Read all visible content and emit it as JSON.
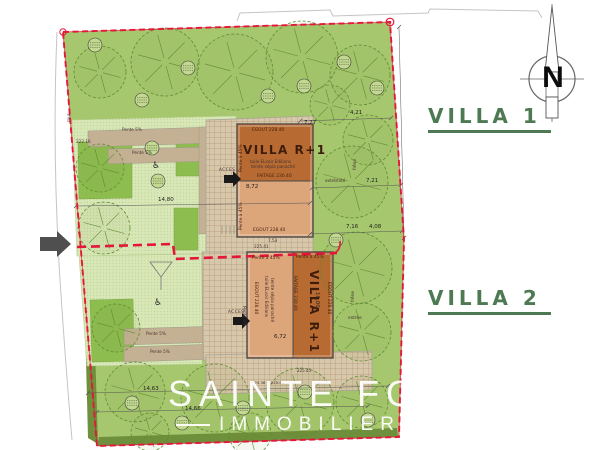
{
  "labels": {
    "villa1": "VILLA 1",
    "villa2": "VILLA 2"
  },
  "compass": {
    "north": "N"
  },
  "logo": {
    "name": "SAINTE FOY",
    "tagline": "IMMOBILIER"
  },
  "v1": {
    "name": "VILLA R+1",
    "egout_top": "EGOUT 228.40",
    "tile_line1": "tuile ELvoir Edilians",
    "tile_line2": "teinte sépia panaché",
    "faitage": "FAITAGE 230.40",
    "width": "8,72",
    "slope_left_top": "Pente à 45%",
    "slope_left_bottom": "Pente à 45%",
    "egout_bottom": "EGOUT 228.40"
  },
  "v2": {
    "name": "VILLA R+1",
    "slope_a": "Pente à 45%",
    "slope_b": "Pente à 45%",
    "faitage": "FAITAGE 230.40",
    "tile_line1": "tuile ELvoir Edilians",
    "tile_line2": "teinte sépia panaché",
    "egout_left": "EGOUT 228.40",
    "egout_right": "EGOUT 228.40",
    "width": "6,72",
    "depth": "10,00"
  },
  "site": {
    "slope1": "Pente 5%",
    "slope2": "Pente 5%",
    "slope3": "Pente 5%",
    "slope4": "Pente 5%",
    "slope5": "Pente 5%",
    "level_222_16": "222.16",
    "dim_14_80": "14,80",
    "acces1": "ACCES",
    "acces2": "ACCES",
    "dim_7_53": "7,53",
    "level_225_41": "225.41",
    "dim_4_21": "4,21",
    "dim_7_27": "7,27",
    "dim_7_16": "7,16",
    "dim_4_08": "4,08",
    "dim_7_21": "7,21",
    "extremite": "extrémité",
    "frene1": "frêne",
    "frene2": "frêne",
    "entree": "entrée",
    "mur": "mur",
    "dim_14_63": "14,63",
    "dim_14_66": "14,66",
    "terrace_levels": "225.36 + 225.80",
    "level_225_45": "225.45"
  },
  "icons": {
    "wheelchair": "♿"
  },
  "colors": {
    "boundary_red": "#e31739",
    "grass": "#a6c76d",
    "lawn": "#d8e7b6",
    "patch": "#8ebd4f",
    "driveway": "#c4b193",
    "court": "#d7c7ab",
    "roof_dark": "#b76a31",
    "roof_light": "#dca57a",
    "dark_hedge": "#6e8f3b",
    "label_green": "#4d7a52"
  }
}
